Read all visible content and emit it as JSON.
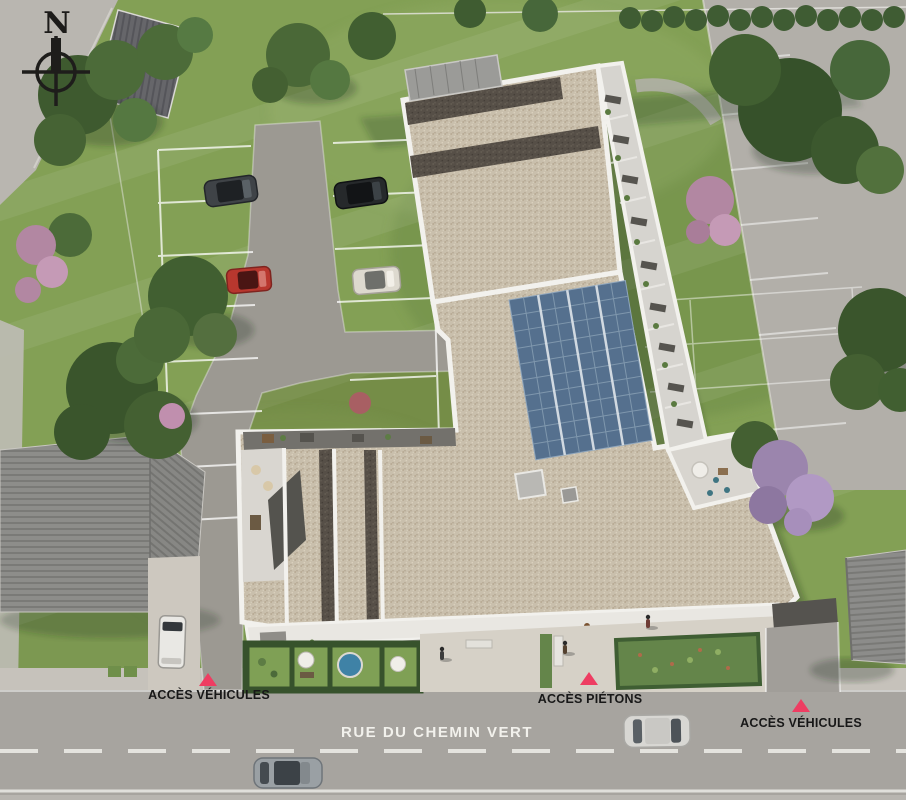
{
  "compass": {
    "label": "N"
  },
  "street": {
    "name": "RUE DU CHEMIN VERT"
  },
  "access_points": [
    {
      "id": "vehicles-left",
      "label": "ACCÈS VÉHICULES"
    },
    {
      "id": "pedestrians",
      "label": "ACCÈS PIÉTONS"
    },
    {
      "id": "vehicles-right",
      "label": "ACCÈS VÉHICULES"
    }
  ],
  "colors": {
    "access_triangle": "#ee3d62",
    "street_asphalt": "#a7a49f",
    "lawn": "#83a055",
    "roof_gravel": "#c9bfac",
    "solar_panel": "#55708e",
    "pool": "#3f82a6",
    "parapet": "#f2f1ed"
  },
  "cars": {
    "parking": [
      {
        "name": "dark-grey-car",
        "color": "#3f4347"
      },
      {
        "name": "black-car",
        "color": "#26292b"
      },
      {
        "name": "red-car",
        "color": "#b8372e"
      },
      {
        "name": "white-car",
        "color": "#ddd9cf"
      }
    ],
    "van": {
      "name": "white-van",
      "color": "#e9e8e4"
    },
    "street": [
      {
        "name": "silver-parked-car",
        "color": "#d8d7d3"
      },
      {
        "name": "grey-driving-car",
        "color": "#9aa0a4"
      }
    ]
  }
}
